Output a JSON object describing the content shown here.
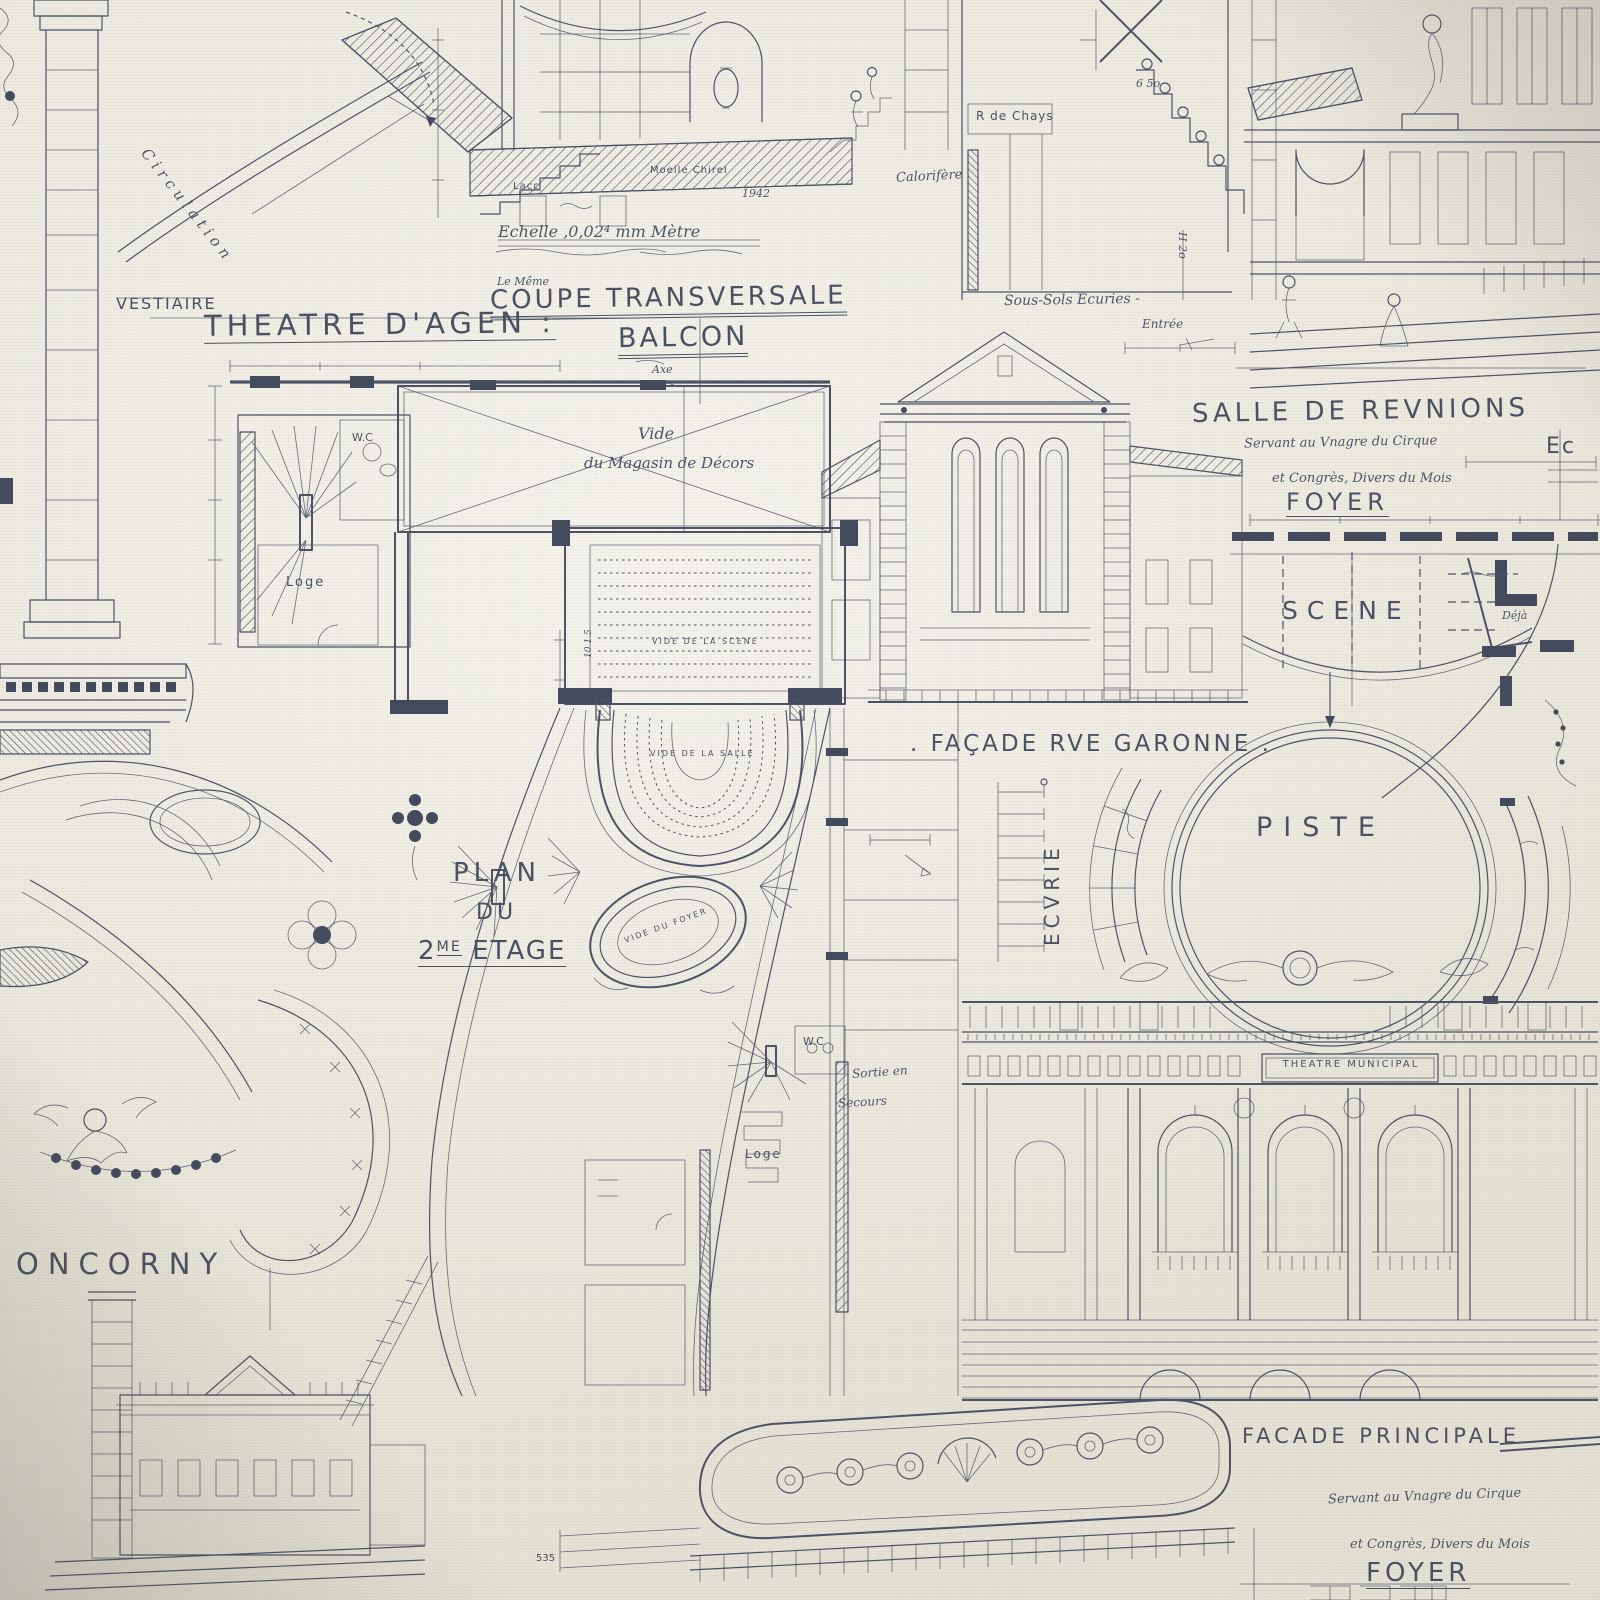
{
  "colors": {
    "ink": "#4c5266",
    "paper": "#eae7db"
  },
  "top_left": {
    "circulation": "Circulation",
    "vestiaire": "VESTIAIRE",
    "theatre_title": "THEATRE D'AGEN :"
  },
  "coupe_panel": {
    "echelle": "Echelle ,0,02⁴ mm Mètre",
    "le_meme": "Le Même",
    "title": "COUPE TRANSVERSALE",
    "subtitle": "BALCON",
    "lacc": "Lacc",
    "moelle": "Moelle Chirel",
    "year": "1942",
    "axe": "Axe"
  },
  "stair_section": {
    "rocchays": "R de Chays",
    "calorifere": "Calorifère",
    "dim_650": "6 5o",
    "h2o": "H 2o",
    "sous_sols": "Sous-Sols  Ecuries -",
    "entree": "Entrée"
  },
  "salle_panel": {
    "title": "SALLE DE REVNIONS",
    "foyer": "FOYER",
    "ec_partial": "Ec",
    "scene": "SCENE",
    "deja": "Déjà"
  },
  "handnotes": {
    "line1": "Servant au Vnagre du Cirque",
    "line2": "et Congrès, Divers du Mois"
  },
  "garonne": {
    "title": ". FAÇADE RVE GARONNE ."
  },
  "piste": {
    "title": "PISTE",
    "ecvrie": "ECVRIE"
  },
  "floor_plan": {
    "vide": "Vide",
    "magasin": "du Magasin de Décors",
    "vide_scene": "VIDE DE LA SCENE",
    "vide_salle": "VIDE DE LA SALLE",
    "vide_foyer": "VIDE DU FOYER",
    "plan": "PLAN",
    "du": "DU",
    "etage_num": "2",
    "etage_sup": "ME",
    "etage_word": "ETAGE",
    "wc_upper": "W.C",
    "loge_upper": "Loge",
    "wc_lower": "W.C",
    "loge_lower": "Loge",
    "sortie_line1": "Sortie en",
    "sortie_line2": "Secours",
    "dim_note": "10 1.5"
  },
  "bottom_left": {
    "name": "ONCORNY"
  },
  "municipal": {
    "banner": "THEATRE MUNICIPAL",
    "facade_title": "FACADE   PRINCIPALE",
    "foyer": "FOYER"
  },
  "bottom_scale": {
    "value": "535"
  }
}
